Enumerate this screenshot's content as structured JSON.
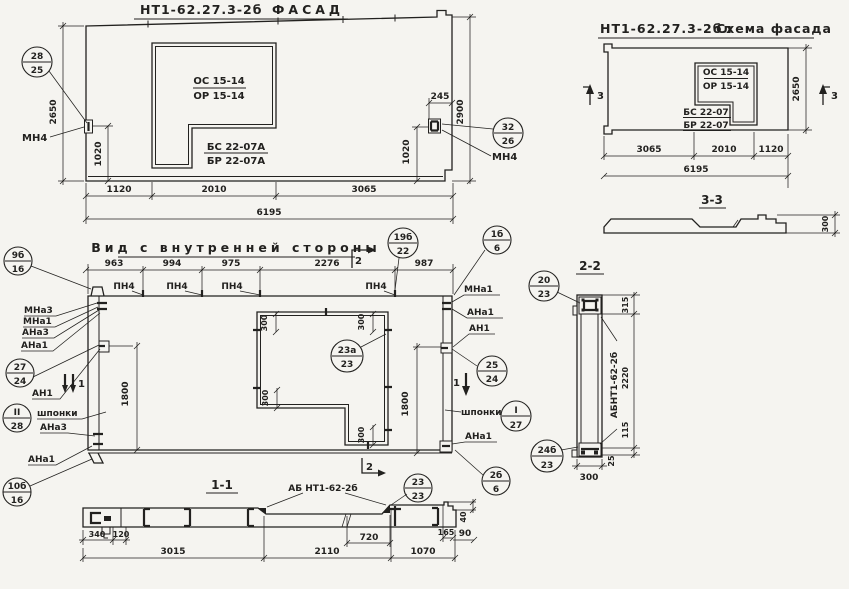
{
  "colors": {
    "paper": "#f5f4f0",
    "ink": "#22211f"
  },
  "facade": {
    "title_code": "НТ1-62.27.3-2б",
    "title_word": "ФАСАД",
    "window_top": "ОС 15-14",
    "window_bottom": "ОР 15-14",
    "block_top": "БС 22-07А",
    "block_bottom": "БР 22-07А",
    "anchor_left": "МН4",
    "anchor_right": "МН4",
    "callout_left": {
      "top": "28",
      "bottom": "25"
    },
    "callout_right": {
      "top": "32",
      "bottom": "26"
    },
    "dims": {
      "h_left": "2650",
      "off_left": "1020",
      "gap_right": "245",
      "h_right": "2900",
      "off_right": "1020",
      "w1": "1120",
      "w2": "2010",
      "w3": "3065",
      "total": "6195"
    }
  },
  "schema": {
    "title_code": "НТ1-62.27.3-2бл",
    "title_word": "Схема фасада",
    "window_top": "ОС 15-14",
    "window_bottom": "ОР 15-14",
    "block_top": "БС 22-07",
    "block_bottom": "БР 22-07",
    "section_mark": "3",
    "dims": {
      "h_right": "2650",
      "w1": "3065",
      "w2": "2010",
      "w3": "1120",
      "total": "6195"
    },
    "section_3_3": {
      "title": "3-3",
      "thickness": "300"
    }
  },
  "inner": {
    "title": "Вид с внутренней стороны",
    "top_dims": [
      "963",
      "994",
      "975",
      "2276",
      "987"
    ],
    "pn_label": "ПН4",
    "section_2": "2",
    "section_1": "1",
    "dim_1800": "1800",
    "dim_300": "300",
    "left_labels": {
      "l1": "МНа3",
      "l2": "МНа1",
      "l3": "АНа3",
      "l4": "АНа1",
      "l5": "АН1",
      "l6": "шпонки",
      "l7": "АНа3",
      "l8": "АНа1"
    },
    "right_labels": {
      "r1": "МНа1",
      "r2": "АНа1",
      "r3": "АН1",
      "r4": "шпонки",
      "r5": "АНа1"
    },
    "callouts": {
      "c9": {
        "top": "9б",
        "bottom": "16"
      },
      "c27": {
        "top": "27",
        "bottom": "24"
      },
      "c28": {
        "top": "II",
        "bottom": "28"
      },
      "c10": {
        "top": "10б",
        "bottom": "16"
      },
      "c19": {
        "top": "19б",
        "bottom": "22"
      },
      "c1_6": {
        "top": "1б",
        "bottom": "6"
      },
      "c23a": {
        "top": "23а",
        "bottom": "23"
      },
      "c25": {
        "top": "25",
        "bottom": "24"
      },
      "c1_27": {
        "top": "I",
        "bottom": "27"
      },
      "c2_6": {
        "top": "2б",
        "bottom": "6"
      },
      "c23": {
        "top": "23",
        "bottom": "23"
      }
    }
  },
  "section22": {
    "title": "2-2",
    "beam_label": "АБНТ1-62-2б",
    "dims": {
      "d315": "315",
      "d2220": "2220",
      "d115": "115",
      "d25": "25",
      "d300": "300"
    },
    "callout_top": {
      "top": "20",
      "bottom": "23"
    },
    "callout_bottom": {
      "top": "24б",
      "bottom": "23"
    }
  },
  "section11": {
    "title": "1-1",
    "beam_label": "АБ НТ1-62-2б",
    "dims": {
      "d340": "340",
      "d120": "120",
      "d3015": "3015",
      "d720": "720",
      "d2110": "2110",
      "d165": "165",
      "d90": "90",
      "d1070": "1070",
      "d40": "40"
    }
  }
}
